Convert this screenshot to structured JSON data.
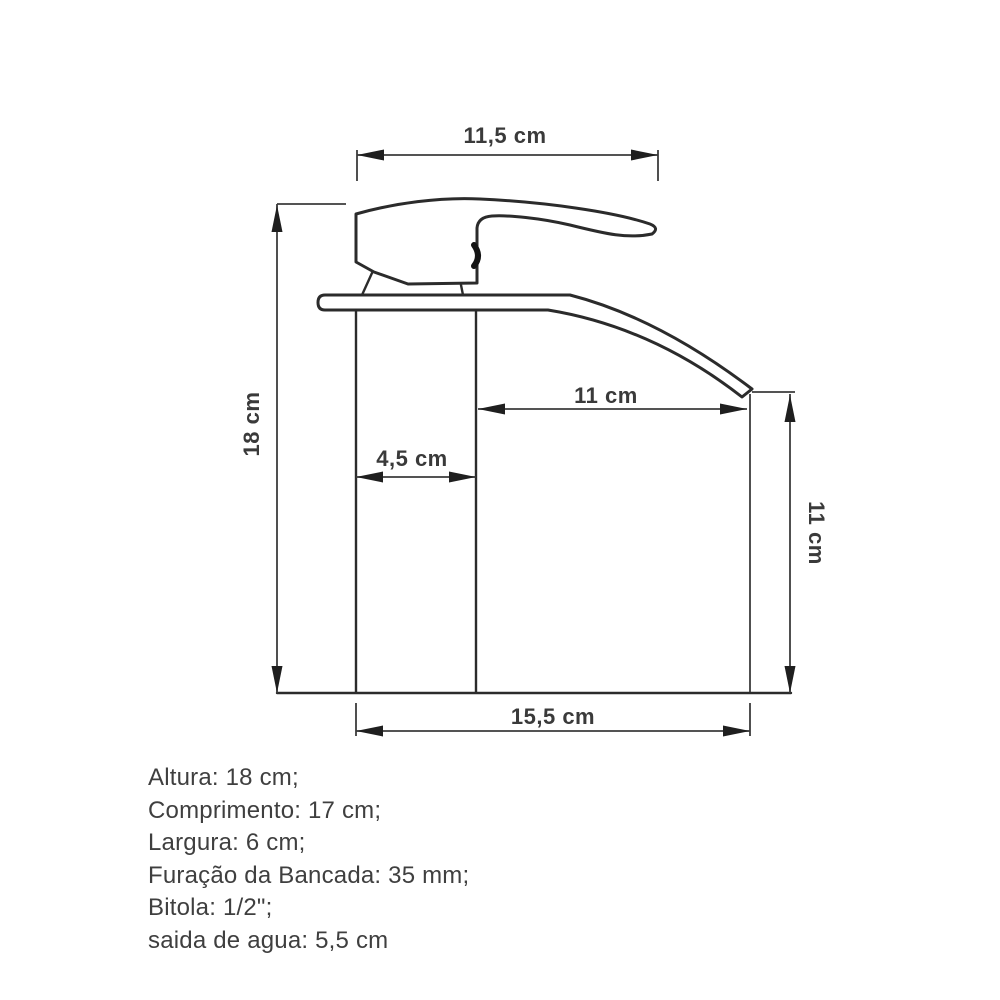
{
  "diagram": {
    "title": "faucet-dimension-drawing",
    "labels": {
      "top_width": "11,5 cm",
      "total_height": "18 cm",
      "body_width": "4,5 cm",
      "spout_reach": "11 cm",
      "spout_height": "11 cm",
      "base_length": "15,5 cm"
    },
    "specs": [
      "Altura: 18 cm;",
      "Comprimento: 17 cm;",
      "Largura: 6 cm;",
      "Furação da Bancada: 35 mm;",
      "Bitola: 1/2\";",
      "saida de agua: 5,5 cm"
    ],
    "colors": {
      "figure_line": "#2b2b2b",
      "dimension_line": "#3c3c3c",
      "arrow_fill": "#1f1f1f",
      "label_text": "#3a3a3a",
      "spec_text": "#3f3f3f",
      "background": "#ffffff"
    }
  }
}
